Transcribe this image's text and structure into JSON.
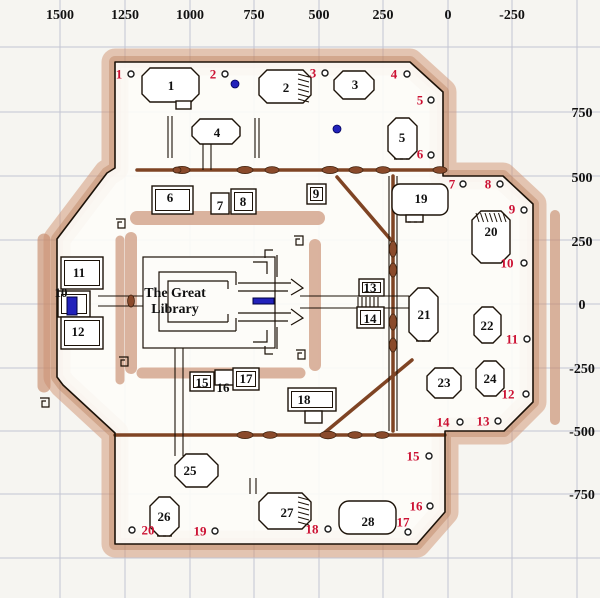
{
  "map_title": "The Great Library",
  "library_label": {
    "line1": "The Great",
    "line2": "Library",
    "x": 175,
    "y1": 297,
    "y2": 313
  },
  "colors": {
    "background": "#f6f5f1",
    "grid": "#c3c5d2",
    "wall_outline": "#1c1208",
    "wall_band_light": "#cf9472",
    "wall_band_dark": "#b97e5a",
    "thick_wall": "#7f4424",
    "door_blob": "#8a4a2b",
    "room_fill": "#ffffff",
    "marker_red": "#cc1133",
    "blue": "#2222bb",
    "text_black": "#111111"
  },
  "axis_top": [
    {
      "label": "1500",
      "x": 60
    },
    {
      "label": "1250",
      "x": 125
    },
    {
      "label": "1000",
      "x": 190
    },
    {
      "label": "750",
      "x": 254
    },
    {
      "label": "500",
      "x": 319
    },
    {
      "label": "250",
      "x": 383
    },
    {
      "label": "0",
      "x": 448
    },
    {
      "label": "-250",
      "x": 512
    }
  ],
  "axis_right": [
    {
      "label": "750",
      "y": 112
    },
    {
      "label": "500",
      "y": 177
    },
    {
      "label": "250",
      "y": 241
    },
    {
      "label": "0",
      "y": 304
    },
    {
      "label": "-250",
      "y": 368
    },
    {
      "label": "-500",
      "y": 431
    },
    {
      "label": "-750",
      "y": 494
    }
  ],
  "grid_x": [
    60,
    125,
    190,
    254,
    319,
    383,
    448,
    512,
    577
  ],
  "grid_y": [
    47,
    112,
    176,
    240,
    304,
    368,
    431,
    494,
    558
  ],
  "rooms": [
    {
      "num": "1",
      "shape": "oct",
      "x": 142,
      "y": 68,
      "w": 57,
      "h": 34,
      "c": 8,
      "lx": 171,
      "ly": 90,
      "tab": [
        176,
        101,
        15,
        8
      ]
    },
    {
      "num": "2",
      "shape": "oct",
      "x": 259,
      "y": 70,
      "w": 52,
      "h": 33,
      "c": 8,
      "lx": 286,
      "ly": 92,
      "hatch": "right"
    },
    {
      "num": "3",
      "shape": "oct",
      "x": 334,
      "y": 71,
      "w": 40,
      "h": 28,
      "c": 9,
      "lx": 355,
      "ly": 89
    },
    {
      "num": "4",
      "shape": "oct",
      "x": 192,
      "y": 119,
      "w": 48,
      "h": 25,
      "c": 8,
      "lx": 217,
      "ly": 137
    },
    {
      "num": "5",
      "shape": "oct",
      "x": 388,
      "y": 118,
      "w": 29,
      "h": 41,
      "c": 8,
      "lx": 402,
      "ly": 142,
      "dash": [
        394,
        159,
        410,
        159
      ]
    },
    {
      "num": "6",
      "shape": "dbox",
      "x": 152,
      "y": 186,
      "w": 41,
      "h": 28,
      "lx": 170,
      "ly": 202
    },
    {
      "num": "7",
      "shape": "box",
      "x": 211,
      "y": 193,
      "w": 18,
      "h": 21,
      "lx": 220,
      "ly": 210
    },
    {
      "num": "8",
      "shape": "dbox",
      "x": 231,
      "y": 189,
      "w": 25,
      "h": 25,
      "lx": 243,
      "ly": 206
    },
    {
      "num": "9",
      "shape": "dbox",
      "x": 307,
      "y": 184,
      "w": 19,
      "h": 20,
      "lx": 316,
      "ly": 198
    },
    {
      "num": "10",
      "shape": "dbox",
      "x": 58,
      "y": 291,
      "w": 32,
      "h": 26,
      "lx": 61,
      "ly": 297
    },
    {
      "num": "11",
      "shape": "dbox",
      "x": 61,
      "y": 257,
      "w": 42,
      "h": 32,
      "lx": 79,
      "ly": 277
    },
    {
      "num": "12",
      "shape": "dbox",
      "x": 61,
      "y": 317,
      "w": 42,
      "h": 32,
      "lx": 78,
      "ly": 336
    },
    {
      "num": "13",
      "shape": "dbox",
      "x": 359,
      "y": 279,
      "w": 25,
      "h": 17,
      "lx": 370,
      "ly": 292
    },
    {
      "num": "14",
      "shape": "dbox",
      "x": 357,
      "y": 307,
      "w": 27,
      "h": 21,
      "lx": 370,
      "ly": 323
    },
    {
      "num": "15",
      "shape": "dbox",
      "x": 190,
      "y": 372,
      "w": 24,
      "h": 19,
      "lx": 202,
      "ly": 387
    },
    {
      "num": "16",
      "shape": "box",
      "x": 215,
      "y": 370,
      "w": 20,
      "h": 15,
      "lx": 223,
      "ly": 392
    },
    {
      "num": "17",
      "shape": "dbox",
      "x": 233,
      "y": 368,
      "w": 26,
      "h": 22,
      "lx": 246,
      "ly": 383
    },
    {
      "num": "18",
      "shape": "dbox",
      "x": 288,
      "y": 388,
      "w": 48,
      "h": 23,
      "lx": 304,
      "ly": 404,
      "tab": [
        305,
        411,
        17,
        12
      ]
    },
    {
      "num": "19",
      "shape": "rrect",
      "x": 392,
      "y": 184,
      "w": 56,
      "h": 31,
      "r": 8,
      "lx": 421,
      "ly": 203,
      "tab": [
        406,
        215,
        17,
        7
      ],
      "dash": [
        408,
        222,
        423,
        222
      ]
    },
    {
      "num": "20",
      "shape": "oct",
      "x": 472,
      "y": 211,
      "w": 38,
      "h": 52,
      "c": 9,
      "lx": 491,
      "ly": 236,
      "hatch": "top"
    },
    {
      "num": "21",
      "shape": "oct",
      "x": 409,
      "y": 288,
      "w": 29,
      "h": 53,
      "c": 9,
      "lx": 424,
      "ly": 319,
      "dash": [
        416,
        341,
        431,
        341
      ]
    },
    {
      "num": "22",
      "shape": "oct",
      "x": 474,
      "y": 307,
      "w": 27,
      "h": 36,
      "c": 8,
      "lx": 487,
      "ly": 330
    },
    {
      "num": "23",
      "shape": "oct",
      "x": 427,
      "y": 368,
      "w": 34,
      "h": 30,
      "c": 8,
      "lx": 444,
      "ly": 387
    },
    {
      "num": "24",
      "shape": "oct",
      "x": 476,
      "y": 361,
      "w": 28,
      "h": 35,
      "c": 8,
      "lx": 490,
      "ly": 383
    },
    {
      "num": "25",
      "shape": "oct",
      "x": 175,
      "y": 454,
      "w": 43,
      "h": 33,
      "c": 11,
      "lx": 190,
      "ly": 475
    },
    {
      "num": "26",
      "shape": "oct",
      "x": 150,
      "y": 497,
      "w": 29,
      "h": 39,
      "c": 9,
      "lx": 164,
      "ly": 521,
      "dash": [
        157,
        536,
        172,
        536
      ]
    },
    {
      "num": "27",
      "shape": "oct",
      "x": 259,
      "y": 493,
      "w": 52,
      "h": 36,
      "c": 9,
      "lx": 287,
      "ly": 517,
      "hatch": "right"
    },
    {
      "num": "28",
      "shape": "rrect",
      "x": 339,
      "y": 501,
      "w": 57,
      "h": 33,
      "r": 10,
      "lx": 368,
      "ly": 526
    }
  ],
  "red_markers": [
    {
      "num": "1",
      "tx": 119,
      "ty": 74,
      "cx": 131,
      "cy": 74
    },
    {
      "num": "2",
      "tx": 213,
      "ty": 74,
      "cx": 225,
      "cy": 74
    },
    {
      "num": "3",
      "tx": 313,
      "ty": 73,
      "cx": 325,
      "cy": 73
    },
    {
      "num": "4",
      "tx": 394,
      "ty": 74,
      "cx": 407,
      "cy": 74
    },
    {
      "num": "5",
      "tx": 420,
      "ty": 100,
      "cx": 431,
      "cy": 100
    },
    {
      "num": "6",
      "tx": 420,
      "ty": 154,
      "cx": 431,
      "cy": 155
    },
    {
      "num": "7",
      "tx": 452,
      "ty": 184,
      "cx": 463,
      "cy": 184
    },
    {
      "num": "8",
      "tx": 488,
      "ty": 184,
      "cx": 500,
      "cy": 184
    },
    {
      "num": "9",
      "tx": 512,
      "ty": 209,
      "cx": 524,
      "cy": 210
    },
    {
      "num": "10",
      "tx": 507,
      "ty": 263,
      "cx": 524,
      "cy": 263
    },
    {
      "num": "11",
      "tx": 512,
      "ty": 339,
      "cx": 527,
      "cy": 339
    },
    {
      "num": "12",
      "tx": 508,
      "ty": 394,
      "cx": 526,
      "cy": 394
    },
    {
      "num": "13",
      "tx": 483,
      "ty": 421,
      "cx": 498,
      "cy": 421
    },
    {
      "num": "14",
      "tx": 443,
      "ty": 422,
      "cx": 460,
      "cy": 422
    },
    {
      "num": "15",
      "tx": 413,
      "ty": 456,
      "cx": 429,
      "cy": 456
    },
    {
      "num": "16",
      "tx": 416,
      "ty": 506,
      "cx": 430,
      "cy": 506
    },
    {
      "num": "17",
      "tx": 403,
      "ty": 522,
      "cx": 408,
      "cy": 532
    },
    {
      "num": "18",
      "tx": 312,
      "ty": 529,
      "cx": 328,
      "cy": 529
    },
    {
      "num": "19",
      "tx": 200,
      "ty": 531,
      "cx": 215,
      "cy": 531
    },
    {
      "num": "20",
      "tx": 148,
      "ty": 530,
      "cx": 132,
      "cy": 530
    }
  ],
  "blue_dots": [
    {
      "x": 235,
      "y": 84
    },
    {
      "x": 337,
      "y": 129
    }
  ],
  "blue_bars": [
    {
      "x": 253,
      "y": 298,
      "w": 21,
      "h": 6
    },
    {
      "x": 67,
      "y": 297,
      "w": 10,
      "h": 18
    }
  ]
}
